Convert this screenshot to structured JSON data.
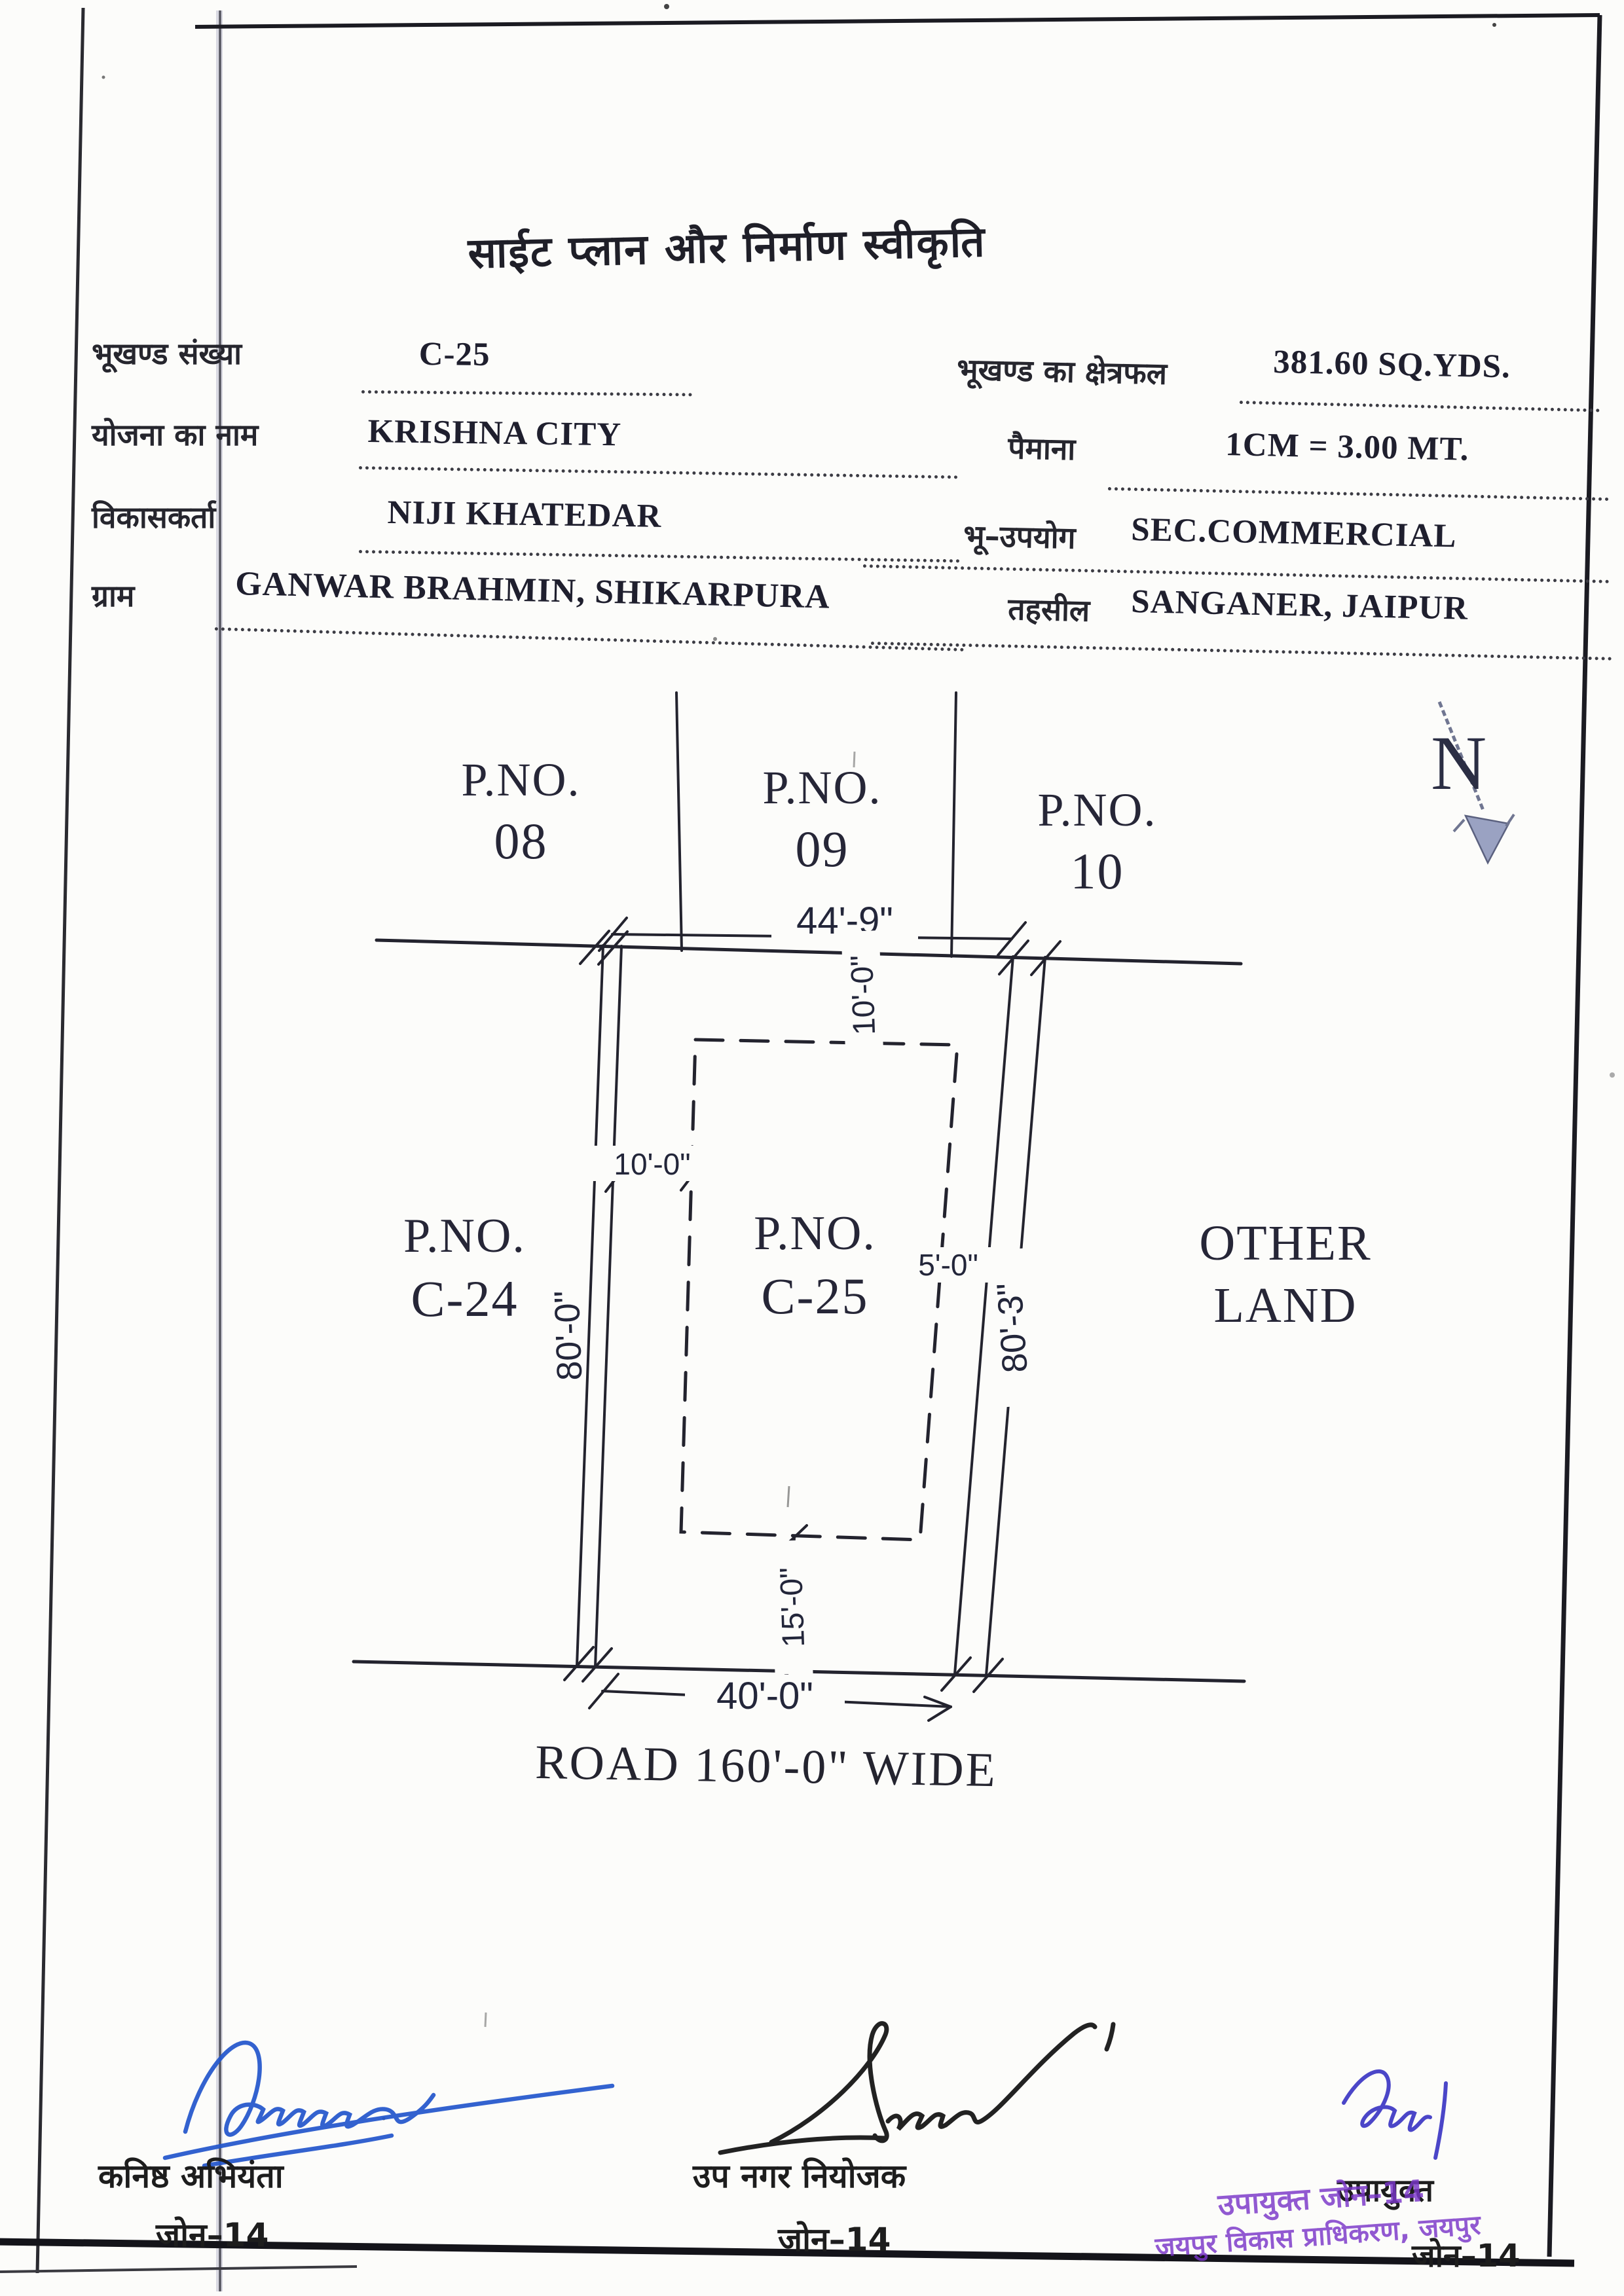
{
  "title": "साईट प्लान और निर्माण स्वीकृति",
  "form": {
    "plot_no_label": "भूखण्ड संख्या",
    "plot_no_value": "C-25",
    "area_label": "भूखण्ड का क्षेत्रफल",
    "area_value": "381.60 SQ.YDS.",
    "scheme_label": "योजना का नाम",
    "scheme_value": "KRISHNA CITY",
    "scale_label": "पैमाना",
    "scale_value": "1CM = 3.00 MT.",
    "developer_label": "विकासकर्ता",
    "developer_value": "NIJI KHATEDAR",
    "landuse_label": "भू–उपयोग",
    "landuse_value": "SEC.COMMERCIAL",
    "village_label": "ग्राम",
    "village_value": "GANWAR BRAHMIN, SHIKARPURA",
    "tehsil_label": "तहसील",
    "tehsil_value": "SANGANER, JAIPUR"
  },
  "plan": {
    "north": "N",
    "plot08": {
      "l1": "P.NO.",
      "l2": "08"
    },
    "plot09": {
      "l1": "P.NO.",
      "l2": "09"
    },
    "plot10": {
      "l1": "P.NO.",
      "l2": "10"
    },
    "plotC24": {
      "l1": "P.NO.",
      "l2": "C-24"
    },
    "plotC25": {
      "l1": "P.NO.",
      "l2": "C-25"
    },
    "other_land": {
      "l1": "OTHER",
      "l2": "LAND"
    },
    "dims": {
      "top_width": "44'-9\"",
      "front_setback": "10'-0\"",
      "left_setback": "10'-0\"",
      "right_setback": "5'-0\"",
      "rear_setback": "15'-0\"",
      "left_depth": "80'-0\"",
      "right_depth": "80'-3\"",
      "bottom_width": "40'-0\""
    },
    "road": "ROAD 160'-0\" WIDE"
  },
  "signatures": {
    "left": {
      "line1": "कनिष्ठ अभियंता",
      "line2": "जोन–14"
    },
    "center": {
      "line1": "उप नगर नियोजक",
      "line2": "जोन–14"
    },
    "right": {
      "line1": "उपायुक्त",
      "line2": "जोन–14"
    }
  },
  "stamp": {
    "line1": "उपायुक्त जोन–14",
    "line2": "जयपुर विकास प्राधिकरण, जयपुर"
  },
  "colors": {
    "ink": "#23232e",
    "stamp_purple": "#7a36c9",
    "signature_blue": "#2256cc",
    "signature_violet": "#4b46c8",
    "north_arrow_fill": "#9aa2c2"
  }
}
